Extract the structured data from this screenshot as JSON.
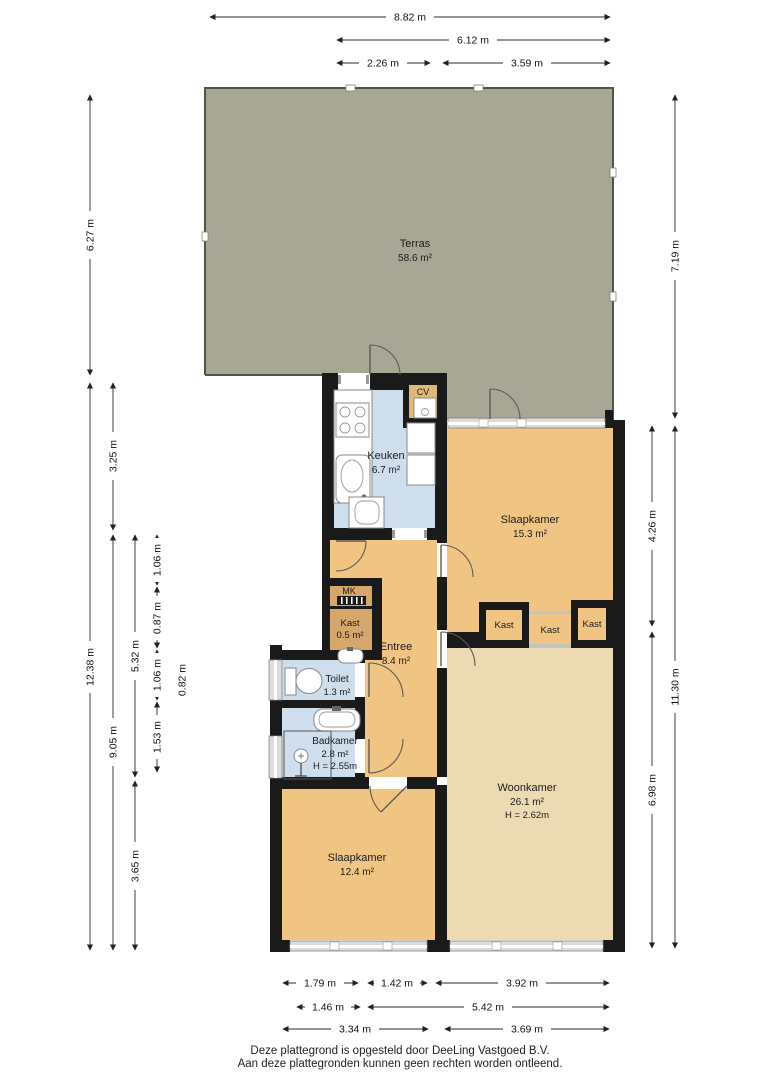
{
  "rooms": {
    "terras": {
      "name": "Terras",
      "area": "58.6 m²"
    },
    "keuken": {
      "name": "Keuken",
      "area": "6.7 m²"
    },
    "slaapkamer_boven": {
      "name": "Slaapkamer",
      "area": "15.3 m²"
    },
    "entree": {
      "name": "Entree",
      "area": "8.4 m²"
    },
    "kast_klein": {
      "name": "Kast",
      "area": "0.5 m²"
    },
    "toilet": {
      "name": "Toilet",
      "area": "1.3 m²"
    },
    "badkamer": {
      "name": "Badkamer",
      "area": "2.8 m²",
      "height": "H = 2.55m"
    },
    "woonkamer": {
      "name": "Woonkamer",
      "area": "26.1 m²",
      "height": "H = 2.62m"
    },
    "slaapkamer_onder": {
      "name": "Slaapkamer",
      "area": "12.4 m²"
    },
    "kast_links": {
      "name": "Kast"
    },
    "kast_midden": {
      "name": "Kast"
    },
    "kast_rechts": {
      "name": "Kast"
    },
    "mk": {
      "name": "MK"
    },
    "cv": {
      "name": "CV"
    }
  },
  "dimensions": {
    "top": [
      "8.82 m",
      "6.12 m",
      "2.26 m",
      "3.59 m"
    ],
    "left": [
      "6.27 m",
      "3.25 m",
      "12.38 m",
      "5.32 m",
      "9.05 m",
      "1.06 m",
      "0.87 m",
      "1.06 m",
      "0.82 m",
      "1.53 m",
      "3.65 m"
    ],
    "right": [
      "7.19 m",
      "4.26 m",
      "11.30 m",
      "6.98 m"
    ],
    "bottom": [
      "1.79 m",
      "1.42 m",
      "3.92 m",
      "1.46 m",
      "5.42 m",
      "3.34 m",
      "3.69 m"
    ]
  },
  "footer": {
    "line1": "Deze plattegrond is opgesteld door DeeLing Vastgoed B.V.",
    "line2": "Aan deze plattegronden kunnen geen rechten worden ontleend."
  },
  "colors": {
    "terras": "#a8a795",
    "orange": "#f0c483",
    "beige": "#ecdbb2",
    "blue": "#cfdeec",
    "kast": "#d5a76c",
    "cv": "#dfb97a",
    "wall": "#1a1a1a"
  }
}
